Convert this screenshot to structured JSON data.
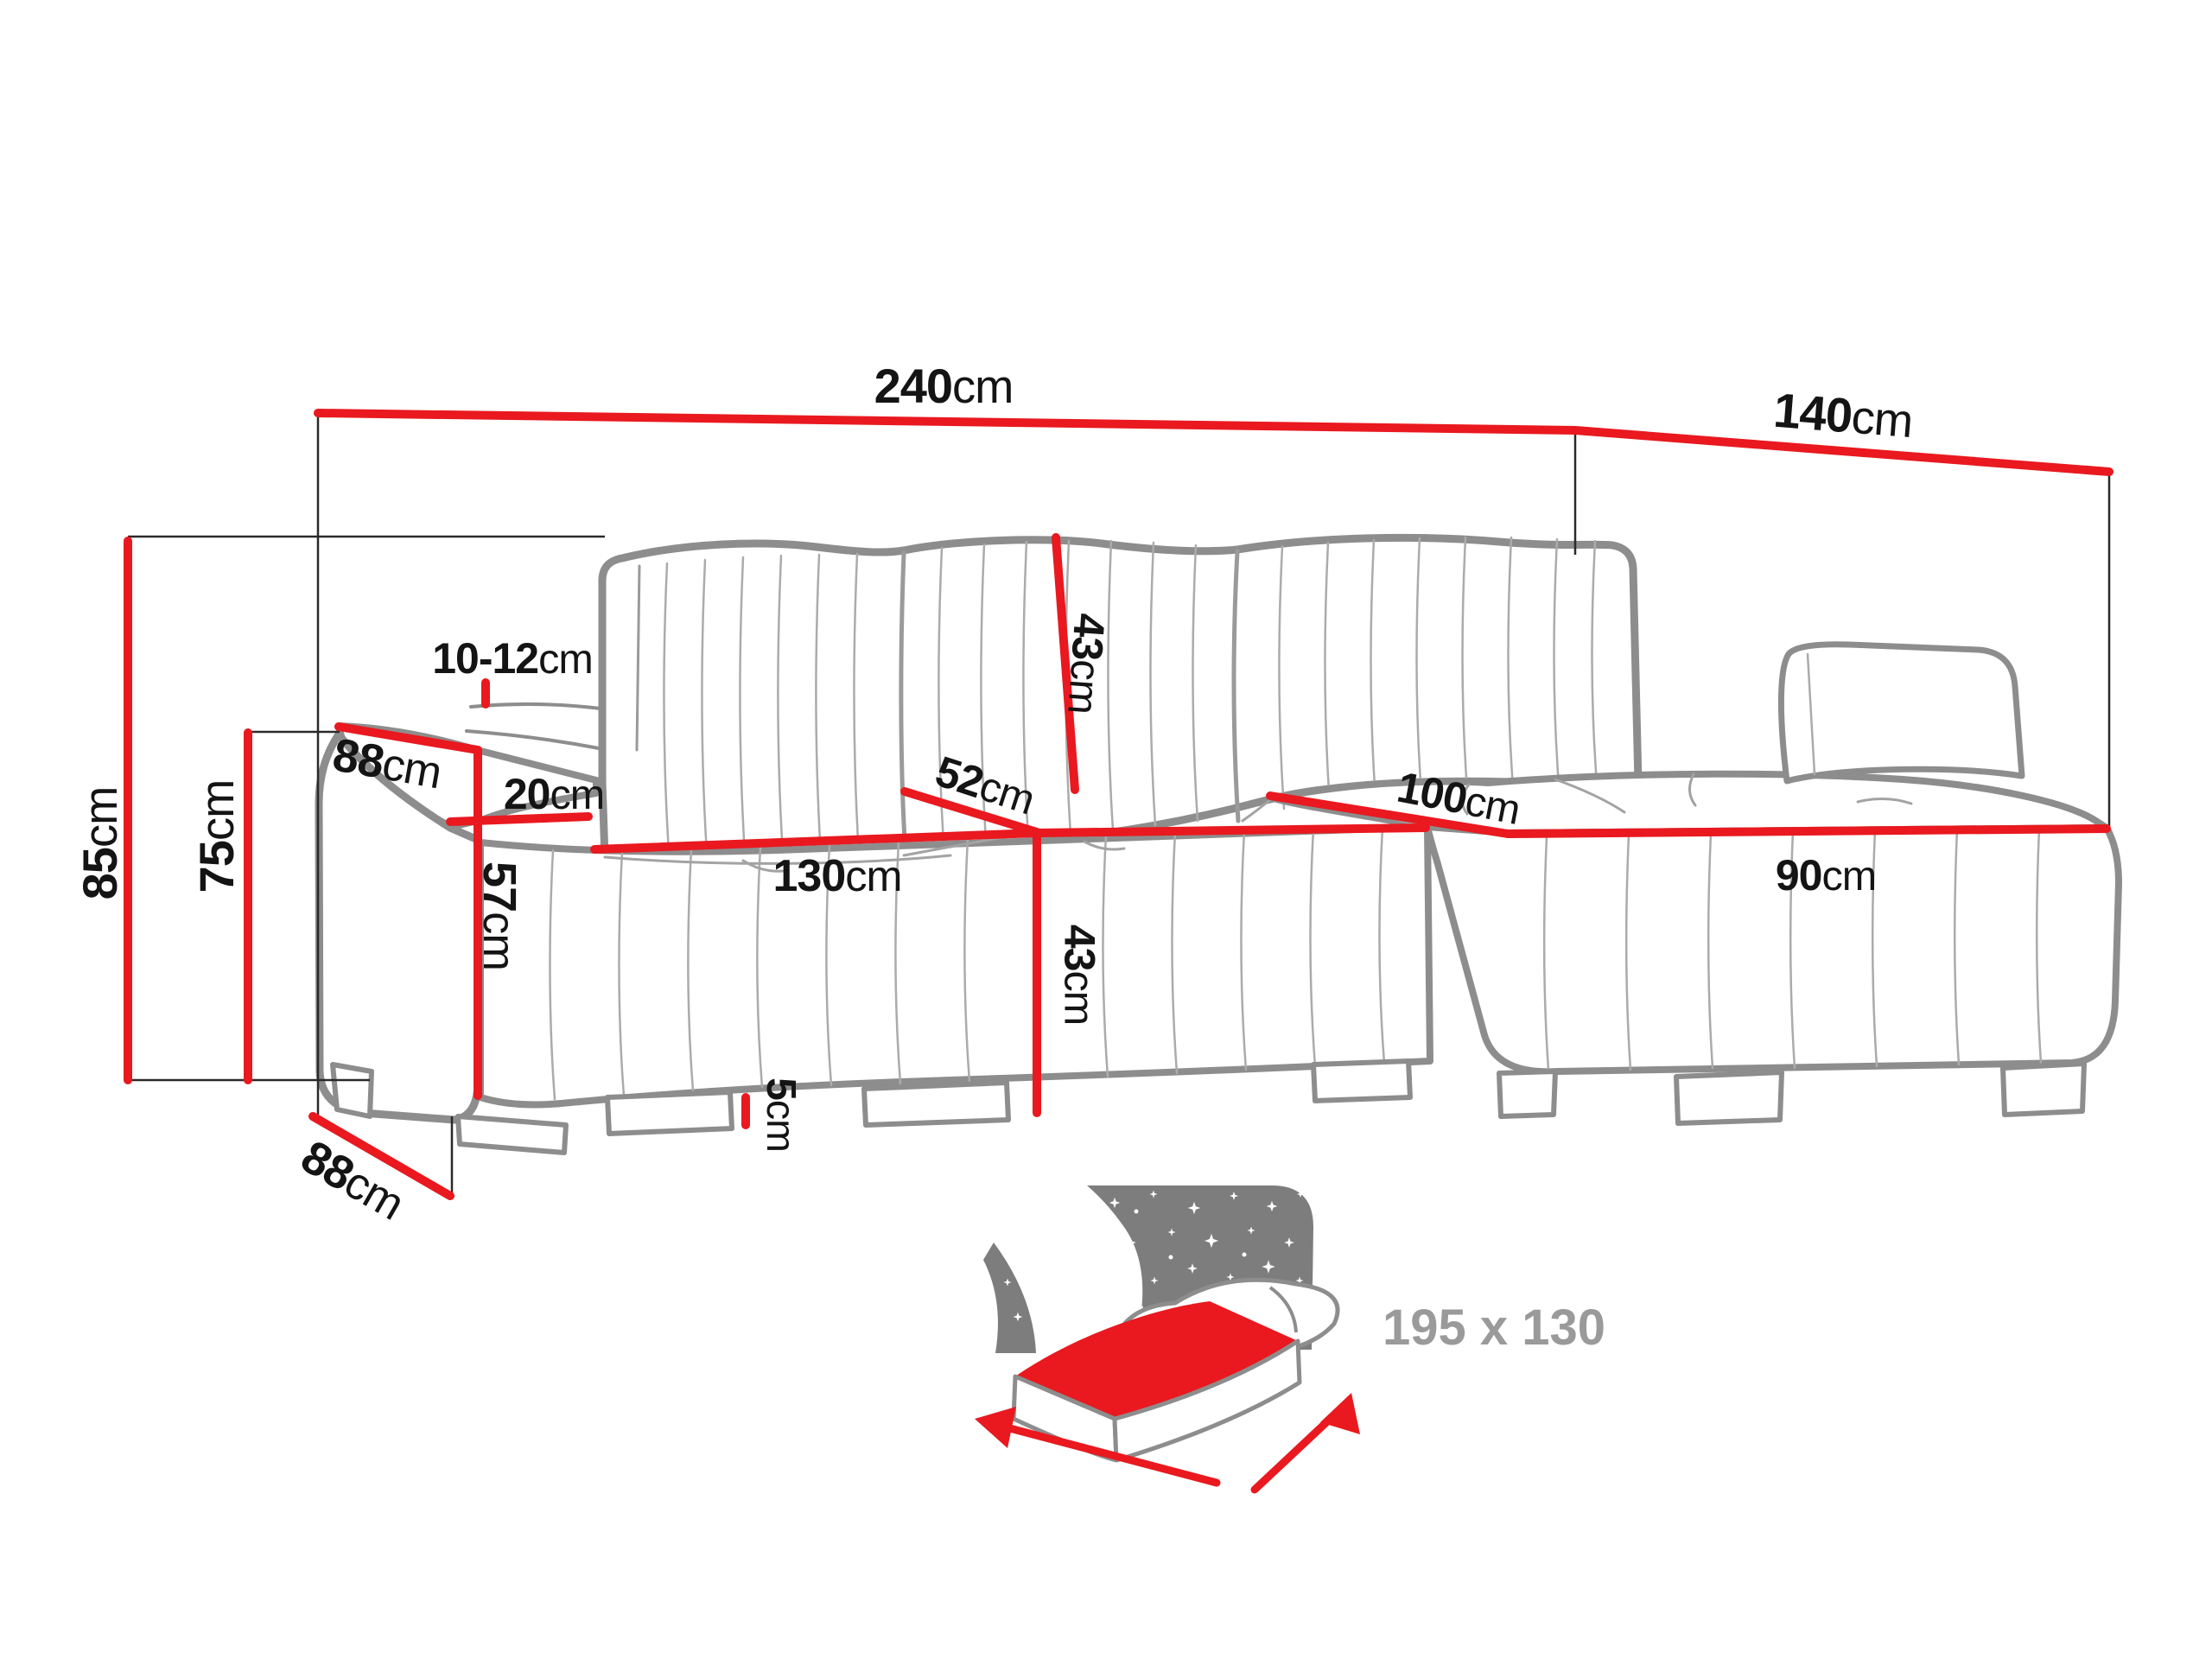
{
  "diagram": {
    "kind": "corner-sofa-dimension-drawing",
    "unit_system": "cm"
  },
  "colors": {
    "dimension_line_red": "#e9191f",
    "sofa_outline_gray": "#8d8d8d",
    "seam_gray": "#a9a9a9",
    "label_black": "#141414",
    "muted_gray": "#9a9a9a",
    "night_sky_gray": "#7d7d7d"
  },
  "icons": {
    "sleeping_function": "bed-with-starry-night-icon"
  },
  "labels": {
    "total_width": {
      "value": "240",
      "unit": "cm"
    },
    "total_depth": {
      "value": "140",
      "unit": "cm"
    },
    "total_height": {
      "value": "85",
      "unit": "cm"
    },
    "backrest_height": {
      "value": "75",
      "unit": "cm"
    },
    "arm_depth": {
      "value": "88",
      "unit": "cm"
    },
    "headrest_gap": {
      "value": "10-12",
      "unit": "cm"
    },
    "arm_width": {
      "value": "20",
      "unit": "cm"
    },
    "arm_height": {
      "value": "57",
      "unit": "cm"
    },
    "seat_front_width": {
      "value": "130",
      "unit": "cm"
    },
    "back_cushion": {
      "value": "43",
      "unit": "cm"
    },
    "seat_diagonal": {
      "value": "52",
      "unit": "cm"
    },
    "seat_height": {
      "value": "43",
      "unit": "cm"
    },
    "foot_height": {
      "value": "5",
      "unit": "cm"
    },
    "base_depth": {
      "value": "88",
      "unit": "cm"
    },
    "chaise_length": {
      "value": "100",
      "unit": "cm"
    },
    "chaise_width": {
      "value": "90",
      "unit": "cm"
    },
    "sleeping_area": {
      "value": "195 x 130"
    }
  }
}
